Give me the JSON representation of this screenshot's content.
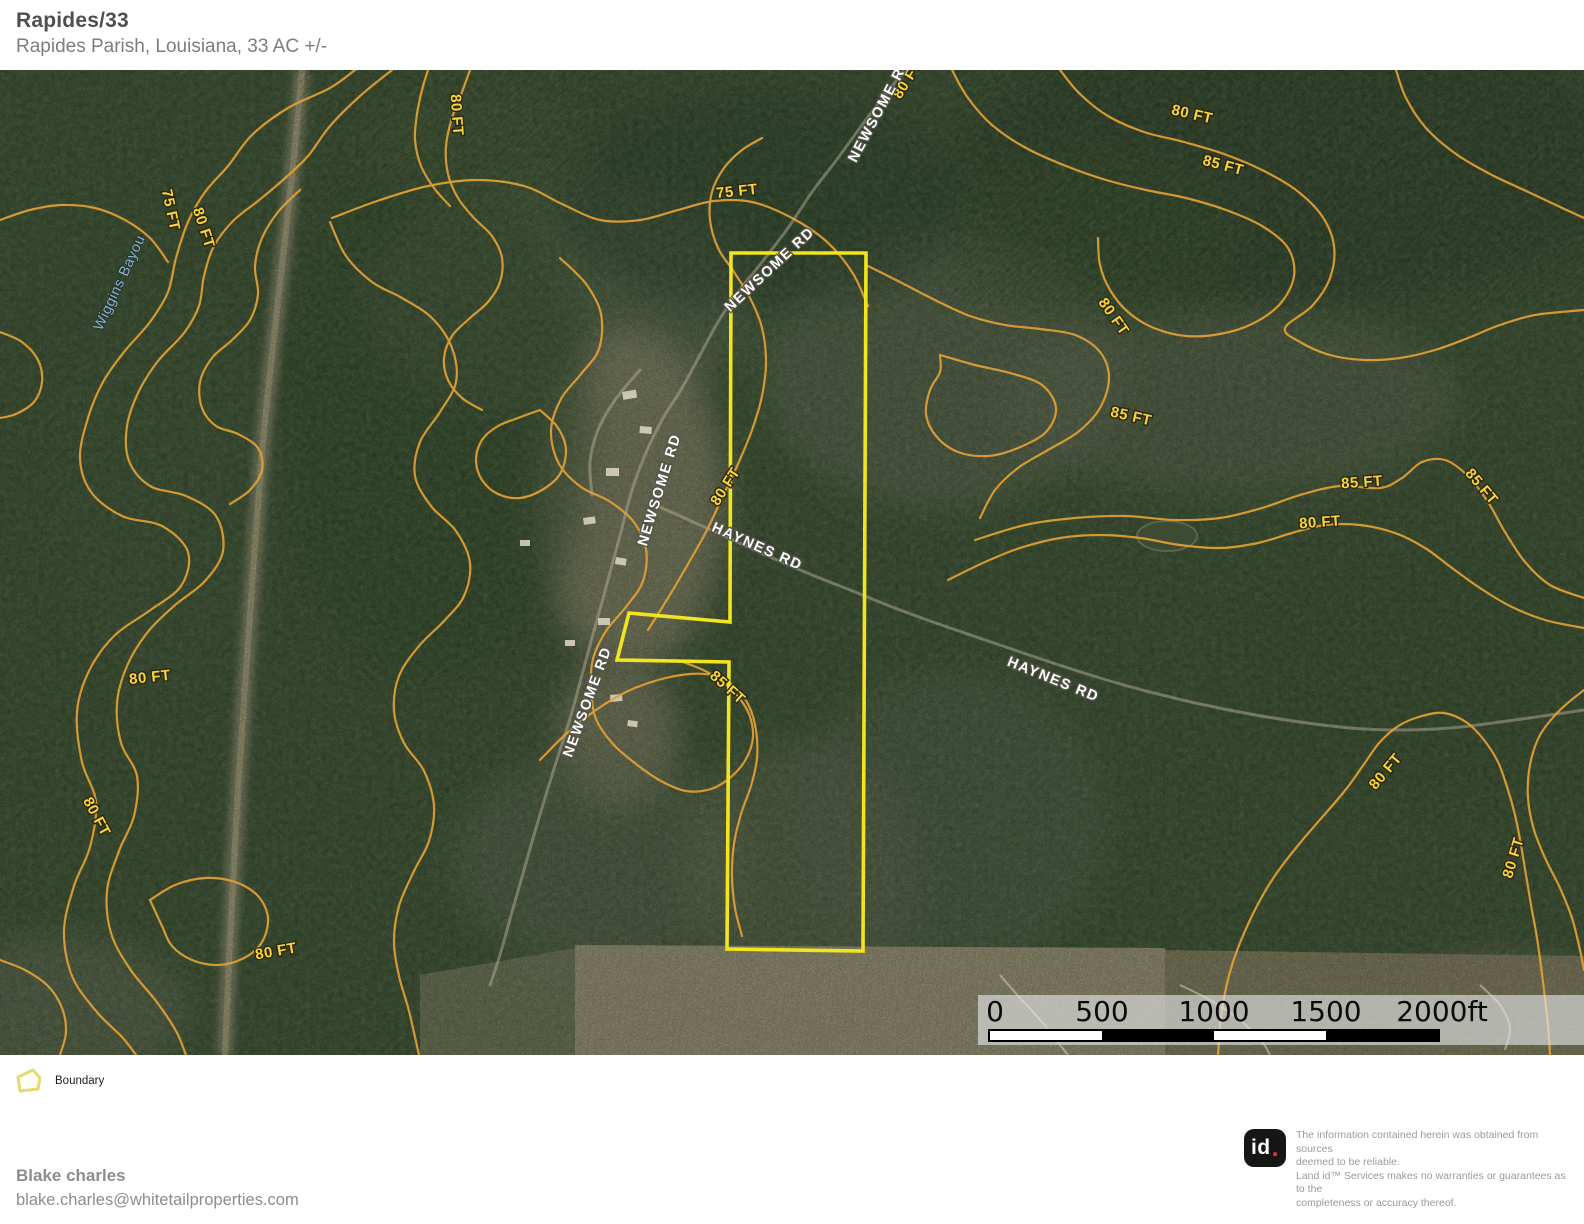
{
  "header": {
    "title": "Rapides/33",
    "subtitle": "Rapides Parish, Louisiana, 33 AC +/-"
  },
  "map": {
    "colors": {
      "contour": "#e2a135",
      "contour_label": "#f7d53c",
      "road_label": "#fdfdfd",
      "water_label": "#8cb2dc",
      "boundary": "#f2e41f"
    },
    "contour_labels": [
      {
        "text": "80 FT",
        "x": 456,
        "y": 45,
        "rot": 86
      },
      {
        "text": "75 FT",
        "x": 170,
        "y": 140,
        "rot": 78
      },
      {
        "text": "80 FT",
        "x": 203,
        "y": 158,
        "rot": 72
      },
      {
        "text": "75 FT",
        "x": 737,
        "y": 122,
        "rot": -6
      },
      {
        "text": "80 FT",
        "x": 908,
        "y": 10,
        "rot": -58
      },
      {
        "text": "80 FT",
        "x": 1192,
        "y": 45,
        "rot": 13
      },
      {
        "text": "85 FT",
        "x": 1223,
        "y": 96,
        "rot": 15
      },
      {
        "text": "80 FT",
        "x": 1113,
        "y": 247,
        "rot": 55
      },
      {
        "text": "85 FT",
        "x": 1131,
        "y": 347,
        "rot": 13
      },
      {
        "text": "85 FT",
        "x": 1362,
        "y": 413,
        "rot": -4
      },
      {
        "text": "85 FT",
        "x": 1481,
        "y": 417,
        "rot": 50
      },
      {
        "text": "80 FT",
        "x": 1320,
        "y": 453,
        "rot": -4
      },
      {
        "text": "80 FT",
        "x": 726,
        "y": 417,
        "rot": -57
      },
      {
        "text": "85 FT",
        "x": 727,
        "y": 618,
        "rot": 42
      },
      {
        "text": "80 FT",
        "x": 150,
        "y": 608,
        "rot": -6
      },
      {
        "text": "80 FT",
        "x": 96,
        "y": 747,
        "rot": 62
      },
      {
        "text": "80 FT",
        "x": 276,
        "y": 882,
        "rot": -10
      },
      {
        "text": "80 FT",
        "x": 1386,
        "y": 702,
        "rot": -50
      },
      {
        "text": "80 FT",
        "x": 1514,
        "y": 788,
        "rot": -73
      }
    ],
    "road_labels": [
      {
        "text": "NEWSOME RD",
        "x": 880,
        "y": 40,
        "rot": -62
      },
      {
        "text": "NEWSOME RD",
        "x": 770,
        "y": 200,
        "rot": -43
      },
      {
        "text": "NEWSOME RD",
        "x": 660,
        "y": 420,
        "rot": -73
      },
      {
        "text": "HAYNES RD",
        "x": 757,
        "y": 477,
        "rot": 24
      },
      {
        "text": "HAYNES RD",
        "x": 1053,
        "y": 610,
        "rot": 22
      },
      {
        "text": "NEWSOME RD",
        "x": 588,
        "y": 632,
        "rot": -70
      }
    ],
    "water_labels": [
      {
        "text": "Wiggins Bayou",
        "x": 120,
        "y": 213,
        "rot": -65
      }
    ],
    "scale_bar": {
      "labels": [
        "0",
        "500",
        "1000",
        "1500",
        "2000ft"
      ]
    }
  },
  "legend": {
    "boundary_label": "Boundary"
  },
  "footer": {
    "agent_name": "Blake charles",
    "agent_email": "blake.charles@whitetailproperties.com",
    "logo_text": "id",
    "logo_dot": ".",
    "disclaimer_lines": [
      "The information contained herein was obtained from sources",
      "deemed to be reliable.",
      " Land id™ Services makes no warranties or guarantees as to the",
      "completeness or accuracy thereof."
    ]
  }
}
